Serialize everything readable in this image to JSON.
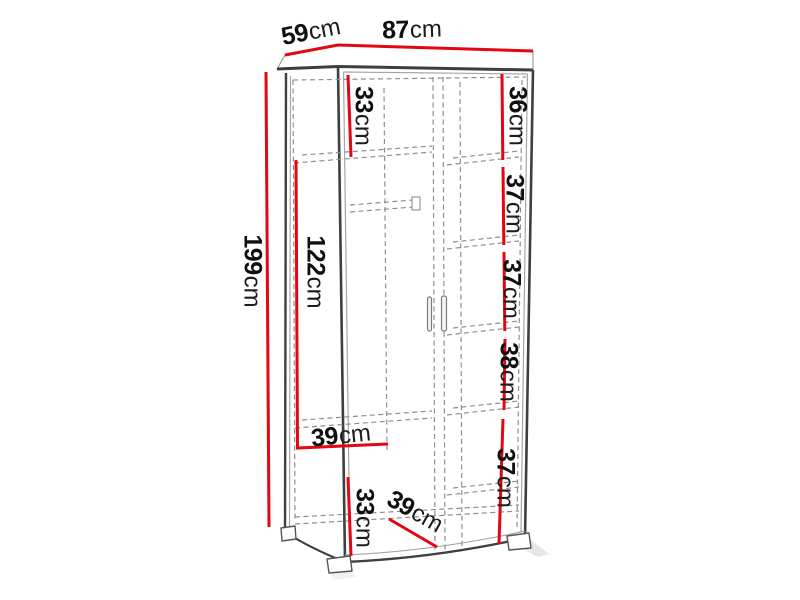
{
  "diagram": {
    "kind": "furniture dimension drawing",
    "unit": "cm"
  },
  "colors": {
    "dimension_line": "#e30613",
    "outline": "#3f3f3f",
    "hidden_line": "#8f8f8f",
    "label_text": "#101010",
    "background": "#ffffff"
  },
  "labels": {
    "depth_top": {
      "value": "59",
      "unit": "cm"
    },
    "width_top": {
      "value": "87",
      "unit": "cm"
    },
    "height_total": {
      "value": "199",
      "unit": "cm"
    },
    "top_shelf_left": {
      "value": "33",
      "unit": "cm"
    },
    "hanging_height": {
      "value": "122",
      "unit": "cm"
    },
    "hanging_width": {
      "value": "39",
      "unit": "cm"
    },
    "bottom_left_height": {
      "value": "33",
      "unit": "cm"
    },
    "bottom_depth": {
      "value": "39",
      "unit": "cm"
    },
    "right_shelf_1": {
      "value": "36",
      "unit": "cm"
    },
    "right_shelf_2": {
      "value": "37",
      "unit": "cm"
    },
    "right_shelf_3": {
      "value": "37",
      "unit": "cm"
    },
    "right_shelf_4": {
      "value": "38",
      "unit": "cm"
    },
    "right_shelf_5": {
      "value": "37",
      "unit": "cm"
    }
  }
}
